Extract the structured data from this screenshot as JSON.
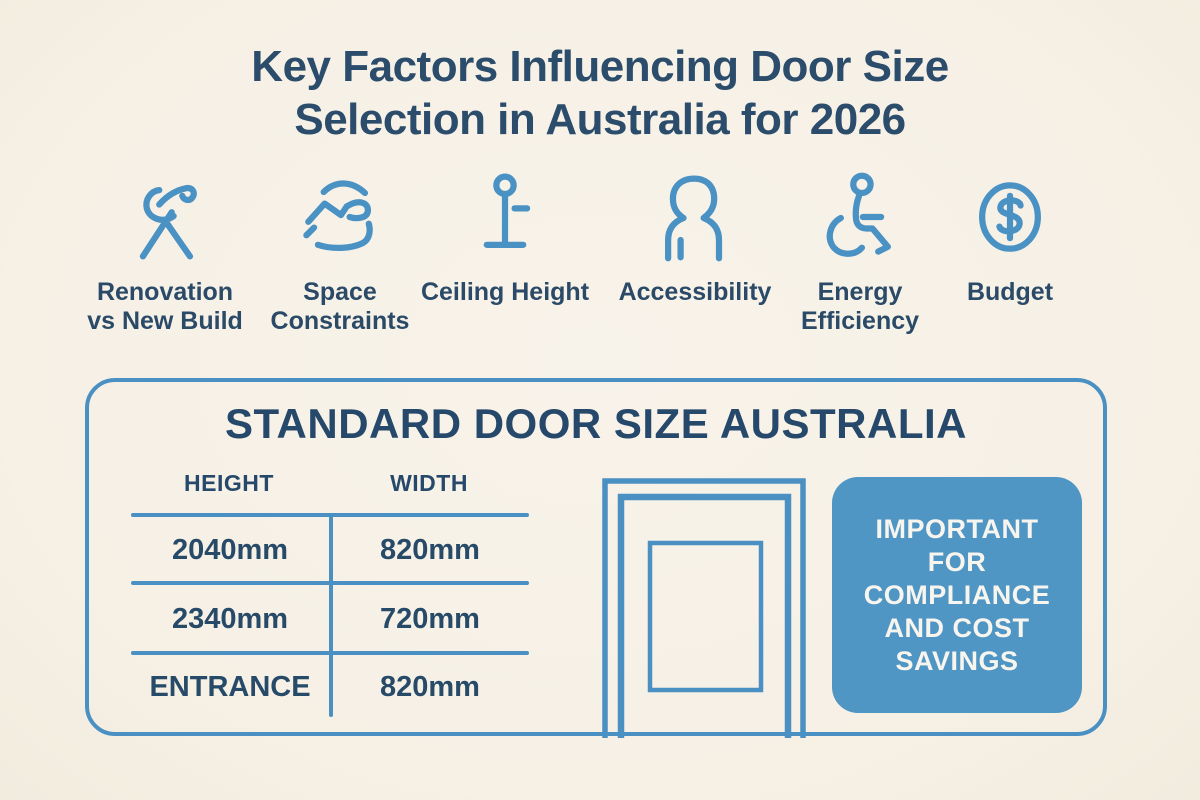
{
  "title": {
    "line1": "Key Factors Influencing Door Size",
    "line2": "Selection in Australia for 2026"
  },
  "factors": [
    {
      "label": "Renovation vs New Build",
      "icon": "wrench-hammer-icon"
    },
    {
      "label": "Space Constraints",
      "icon": "room-space-icon"
    },
    {
      "label": "Ceiling Height",
      "icon": "ceiling-height-icon"
    },
    {
      "label": "Accessibility",
      "icon": "person-icon"
    },
    {
      "label": "Energy Efficiency",
      "icon": "wheelchair-icon"
    },
    {
      "label": "Budget",
      "icon": "dollar-icon"
    }
  ],
  "standard_box": {
    "title": "STANDARD DOOR SIZE AUSTRALIA",
    "table": {
      "headers": {
        "height": "HEIGHT",
        "width": "WIDTH"
      },
      "rows": [
        {
          "height": "2040mm",
          "width": "820mm"
        },
        {
          "height": "2340mm",
          "width": "720mm"
        },
        {
          "height": "ENTRANCE",
          "width": "820mm"
        }
      ]
    },
    "callout": {
      "lines": [
        "IMPORTANT",
        "FOR",
        "COMPLIANCE",
        "AND COST",
        "SAVINGS"
      ]
    }
  },
  "colors": {
    "background": "#f7f1e7",
    "accent_blue": "#4a91c4",
    "navy_text": "#2b4c6b",
    "callout_fill": "#4f96c5",
    "callout_text": "#f8f5ee"
  }
}
